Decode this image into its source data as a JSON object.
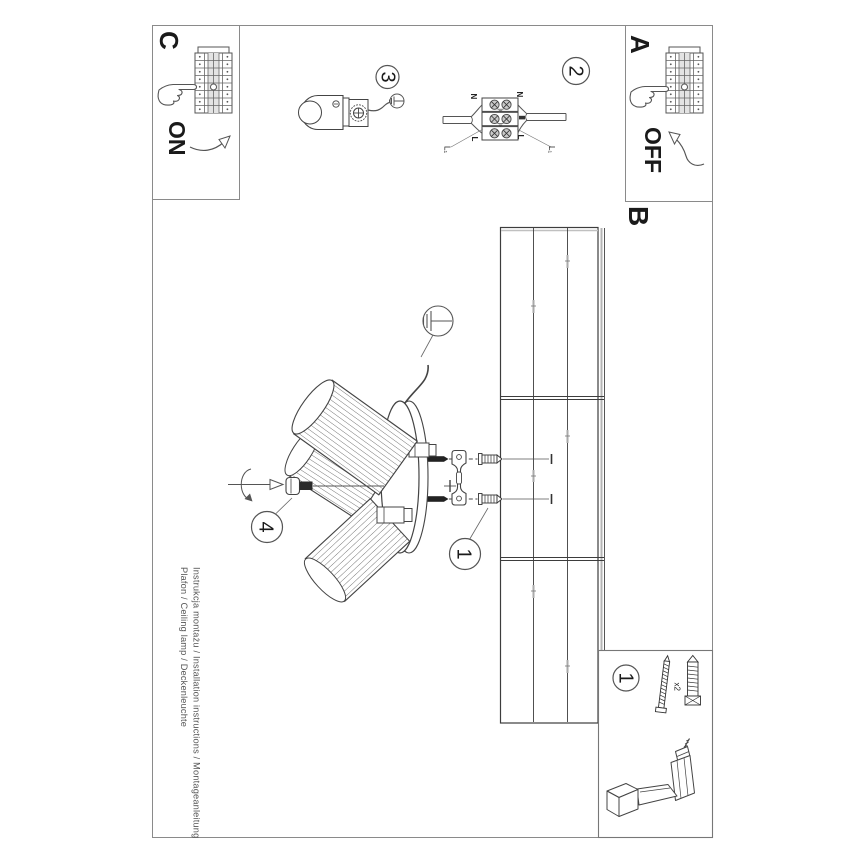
{
  "panel_c": {
    "label": "C",
    "switch_state": "ON"
  },
  "panel_a": {
    "label": "A",
    "switch_state": "OFF"
  },
  "section_b": {
    "label": "B"
  },
  "steps": {
    "s1": "1",
    "s2": "2",
    "s3": "3",
    "s4": "4"
  },
  "wiring": {
    "neutral_left": "N",
    "neutral_right": "N",
    "line_left": "L",
    "line_right": "L",
    "l1_left": "L₁",
    "l1_right": "L₁"
  },
  "parts": {
    "step": "1",
    "screw_qty": "x2"
  },
  "footer": {
    "line1": "Instrukcja montażu / Installation instructions / Montageanleitung",
    "line2": "Plafon / Ceiling lamp / Deckenleuchte"
  },
  "colors": {
    "line": "#3f3f3f",
    "light_line": "#8a8a8a",
    "background": "#ffffff"
  }
}
